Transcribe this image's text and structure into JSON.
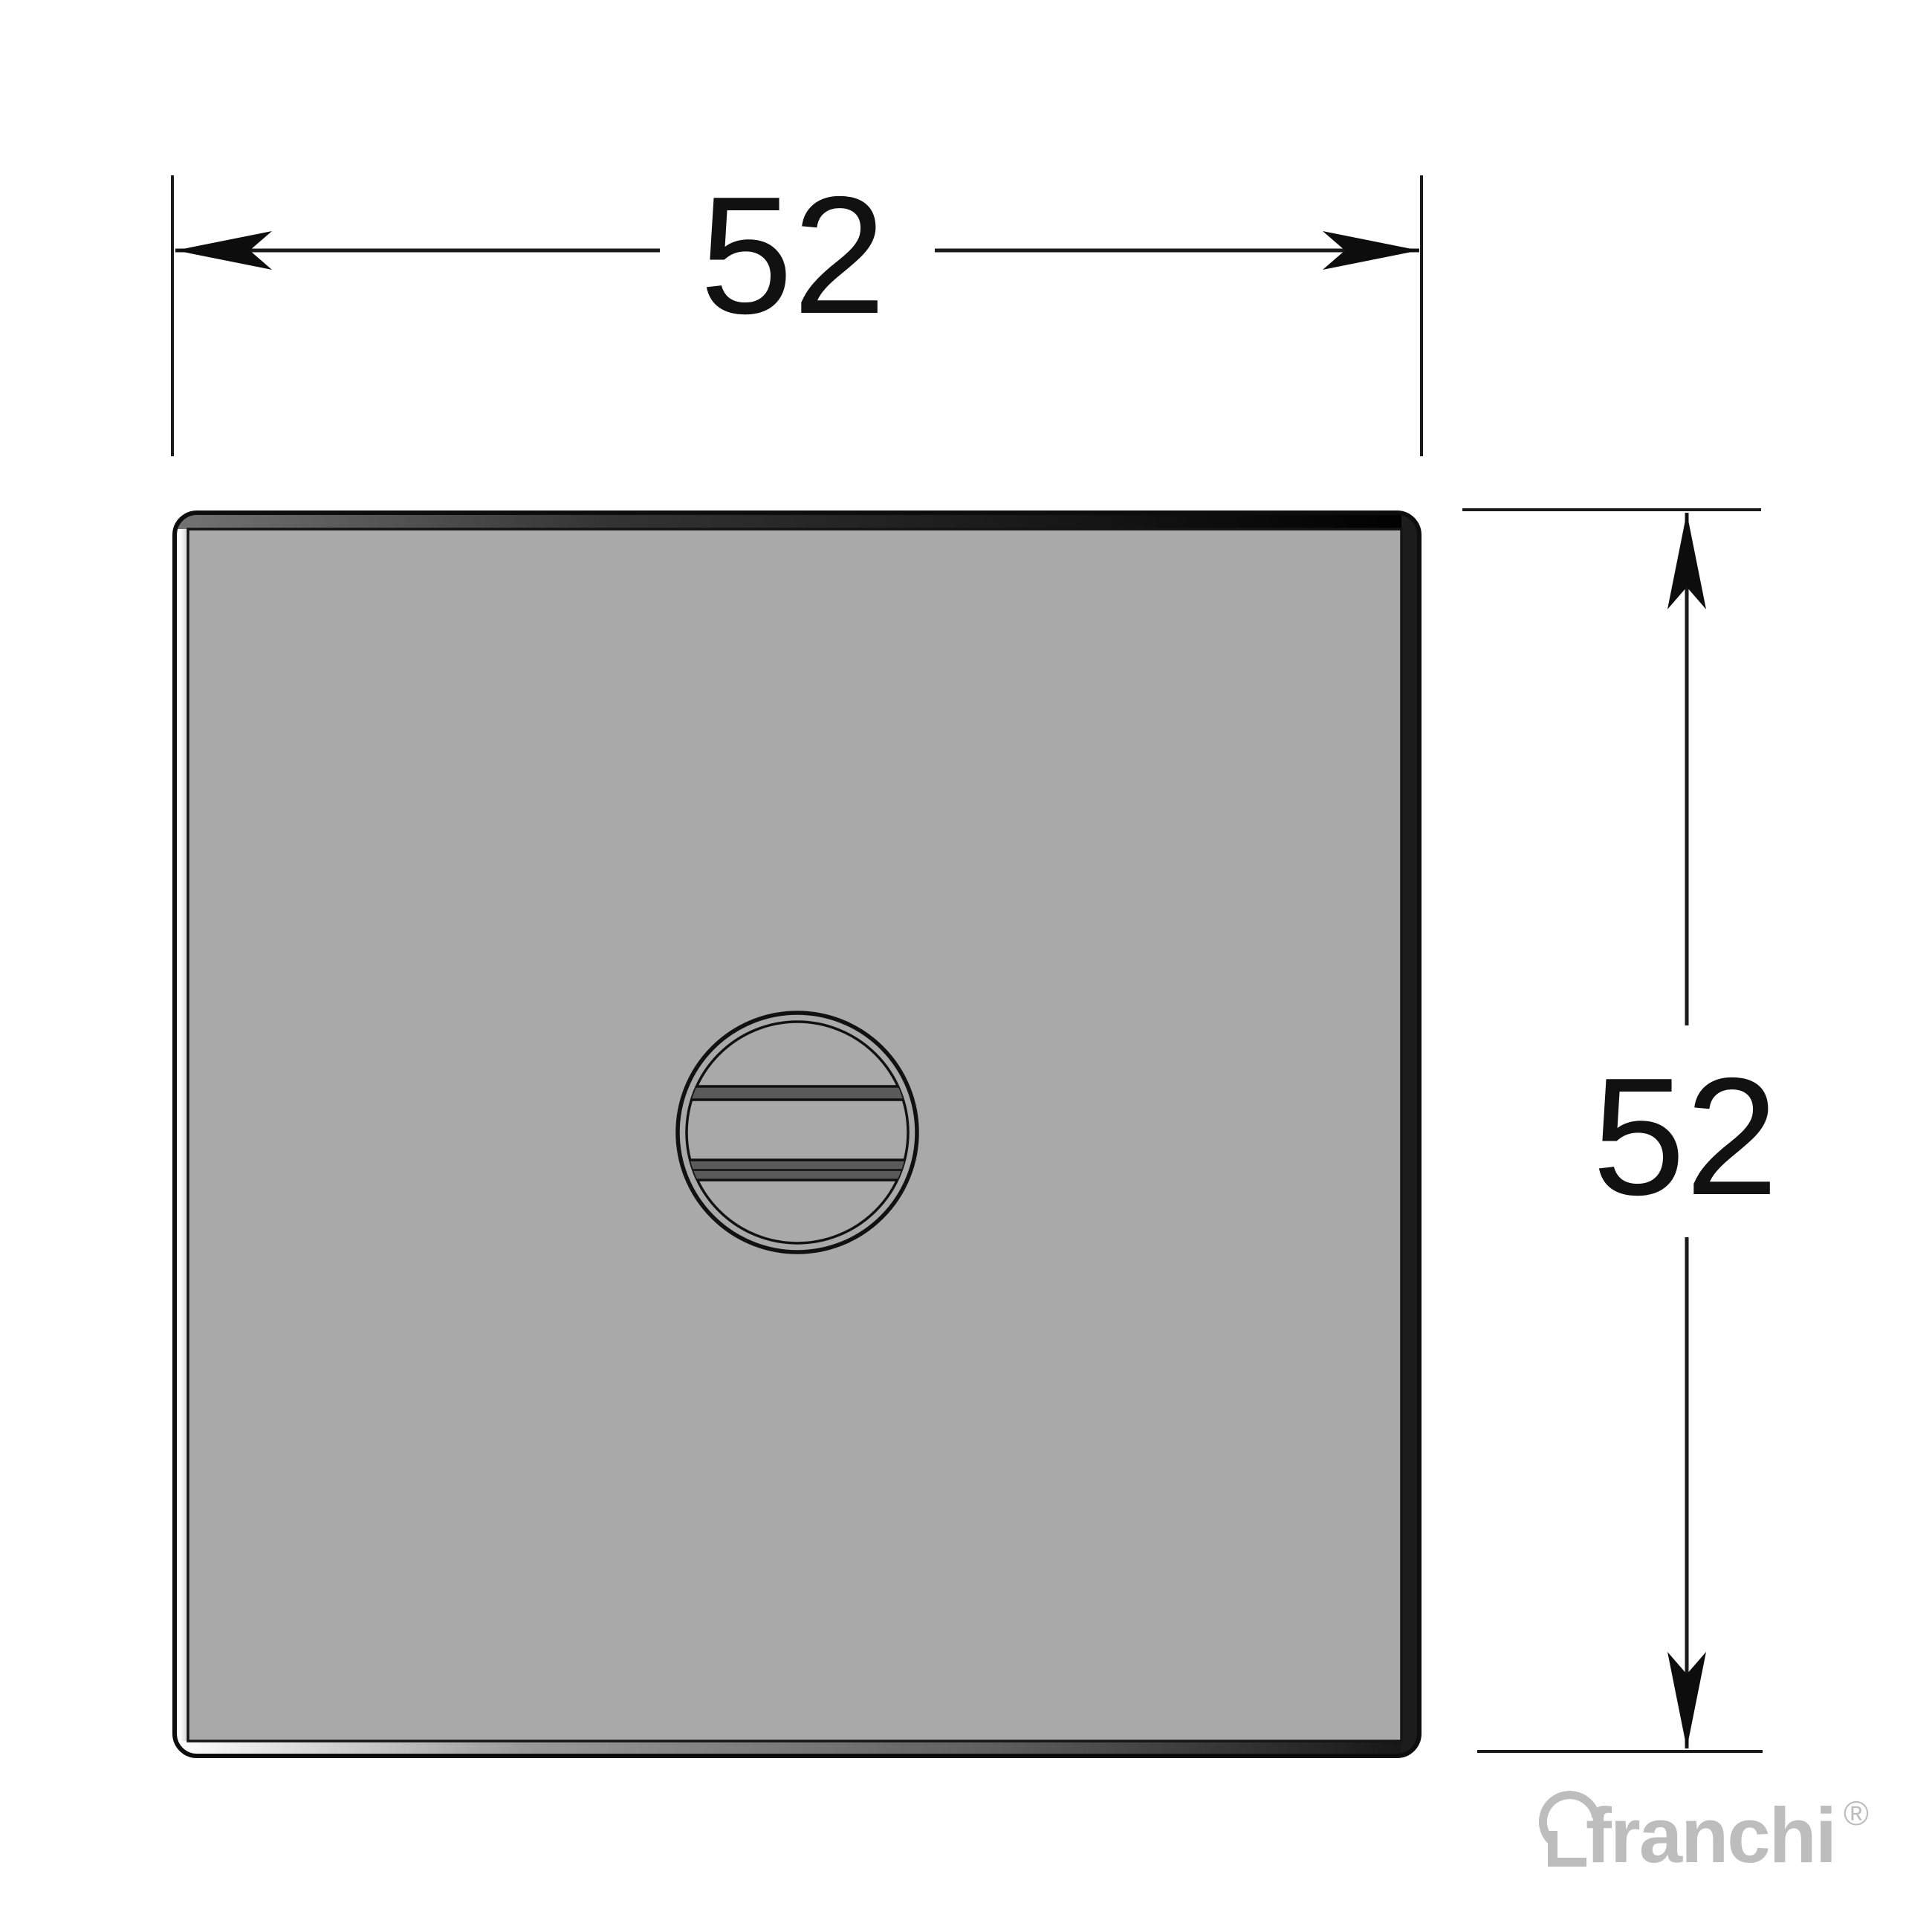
{
  "canvas": {
    "background": "#ffffff",
    "line_color": "#1a1a1a",
    "outline_color": "#0d0d0d"
  },
  "dimensions": {
    "width": {
      "value": "52"
    },
    "height": {
      "value": "52"
    }
  },
  "plate": {
    "face_color": "#a9a9a9"
  },
  "screw": {
    "slot_color": "#5a5a5a"
  },
  "logo": {
    "brand": "franchi",
    "registered_mark": "®",
    "color": "#bdbdbd"
  }
}
